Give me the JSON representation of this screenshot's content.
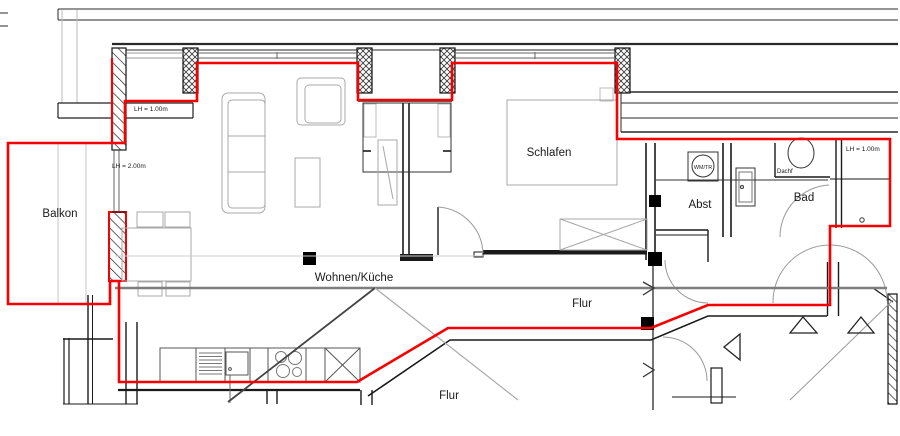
{
  "plan": {
    "title": "apartment-floor-plan",
    "rooms": {
      "balkon": "Balkon",
      "wohnen_kueche": "Wohnen/Küche",
      "schlafen": "Schlafen",
      "abst": "Abst",
      "bad": "Bad",
      "flur_right": "Flur",
      "flur_bottom": "Flur",
      "wm_tr": "WM/TR",
      "dachf": "Dachf"
    },
    "annotations": {
      "lh_top_left": "LH = 1.00m",
      "lh_left": "LH = 2.00m",
      "lh_right": "LH = 1.00m"
    },
    "colors": {
      "apartment_outline": "#f60000",
      "wall": "#1a1a1a",
      "furniture": "#a8a8a8",
      "section_line": "#7e7e7e"
    }
  }
}
